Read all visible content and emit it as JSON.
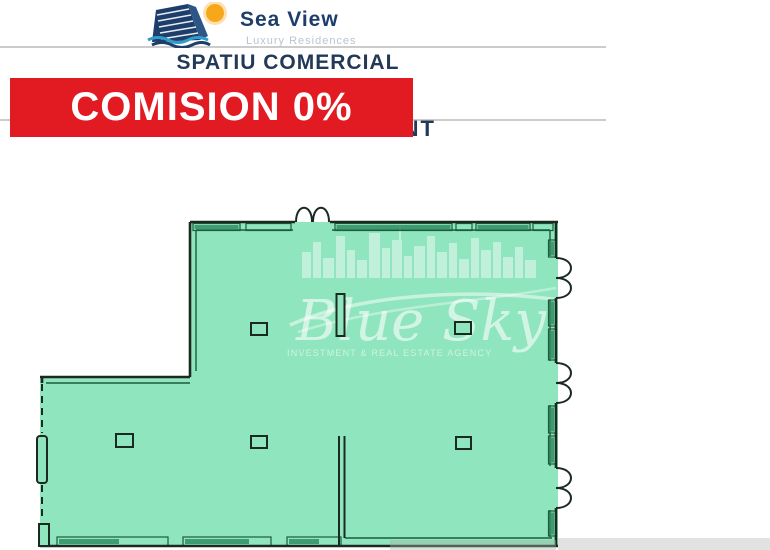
{
  "header": {
    "logo": {
      "title": "Sea View",
      "subtitle": "Luxury Residences"
    },
    "heading": "SPATIU COMERCIAL",
    "banner_label": "COMISION 0%"
  },
  "floor_plan": {
    "room_label": "RESTAURANT",
    "watermark_name": "Blue Sky",
    "watermark_tagline": "INVESTMENT & REAL ESTATE AGENCY"
  },
  "colors": {
    "navy": "#223a57",
    "logo-blue": "#1d3d6b",
    "logo-subtitle": "#b9c4d1",
    "banner-red": "#e21b23",
    "banner-text": "#ffffff",
    "divider-gray": "#cccccc",
    "plan-green": "#8fe5bd",
    "wall-dark": "#1b2a20",
    "wall-inner": "#1d5c3c",
    "window-hatch": "#2f8f63",
    "watermark-white": "#ffffff",
    "shadow-gray": "#e2e2e2",
    "sun-orange": "#f7a81b",
    "wave-blue": "#2e9dc9"
  }
}
